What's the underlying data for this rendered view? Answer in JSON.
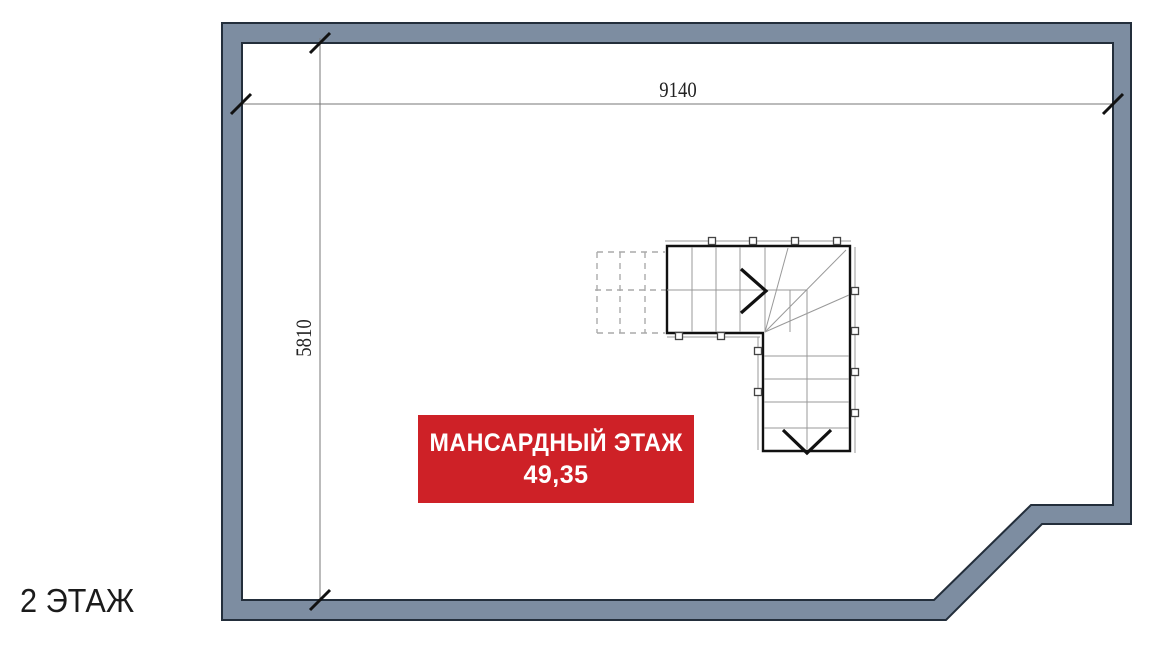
{
  "floor_plan": {
    "floor_label": "2 ЭТАЖ",
    "dimension_width": "9140",
    "dimension_height": "5810",
    "area_badge": {
      "title": "МАНСАРДНЫЙ ЭТАЖ",
      "value": "49,35"
    },
    "icons": {
      "stair_up_arrow": "chevron-right",
      "stair_down_arrow": "chevron-down"
    },
    "colors": {
      "wall_fill": "#7d8da1",
      "wall_outline": "#232e3b",
      "badge_bg": "#ce2127",
      "badge_text": "#ffffff",
      "dim_line": "#777777",
      "tick_mark": "#111111",
      "stair_outline": "#111111",
      "stair_steps": "#999999",
      "dashed_stair": "#aaaaaa"
    }
  }
}
